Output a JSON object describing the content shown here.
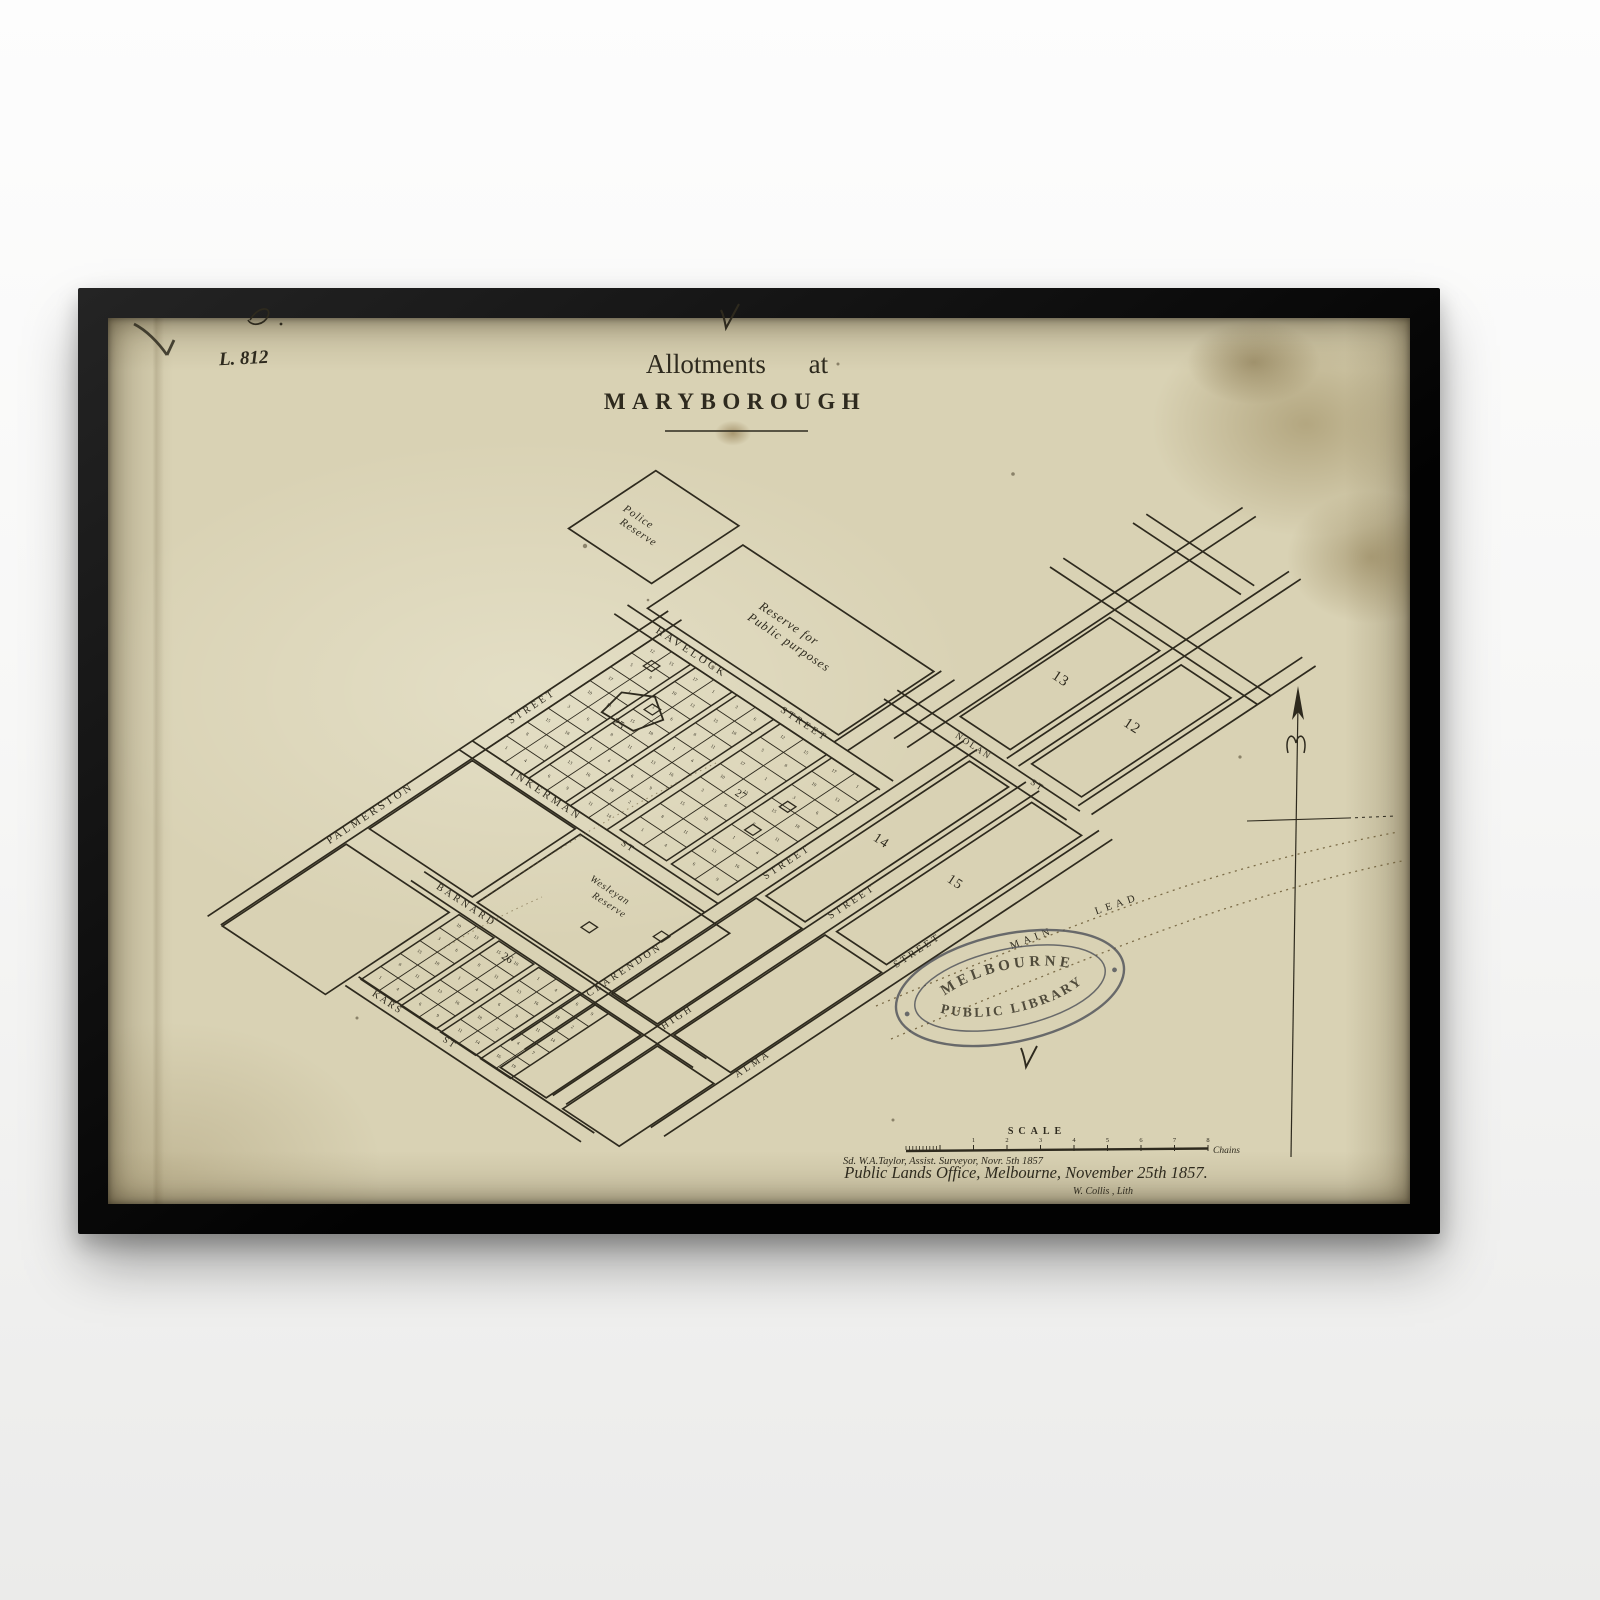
{
  "map": {
    "ink": "#2e2a1e",
    "stamp_ink": "#4d5058",
    "paper_color": "#d9d2b4",
    "catalog_number": "L. 812",
    "title": {
      "line1": "Allotments at",
      "line2": "MARYBOROUGH"
    },
    "reserves": {
      "police_l1": "Police",
      "police_l2": "Reserve",
      "public_l1": "Reserve for",
      "public_l2": "Public purposes",
      "wesleyan_l1": "Wesleyan",
      "wesleyan_l2": "Reserve"
    },
    "streets": {
      "palmerston": "PALMERSTON",
      "palmerston_st": "STREET",
      "inkerman": "INKERMAN",
      "inkerman_st": "ST",
      "havelock": "HAVELOCK",
      "havelock_st": "STREET",
      "barnard": "BARNARD",
      "kars": "KARS",
      "kars_st": "ST",
      "clarendon": "CLARENDON",
      "clarendon_st": "STREET",
      "high": "HIGH",
      "high_st": "STREET",
      "alma": "ALMA",
      "alma_st": "STREET",
      "nolan": "NOLAN",
      "nolan_st": "ST"
    },
    "blocks": {
      "b12": "12",
      "b13": "13",
      "b14": "14",
      "b15": "15",
      "b25": "25",
      "b26": "26",
      "b27": "27"
    },
    "lead": {
      "main": "MAIN",
      "lead": "LEAD"
    },
    "stamp": {
      "top": "MELBOURNE",
      "bottom": "PUBLIC LIBRARY"
    },
    "scale": {
      "title": "SCALE",
      "unit": "Chains",
      "ticks": [
        "1",
        "2",
        "3",
        "4",
        "5",
        "6",
        "7",
        "8"
      ]
    },
    "imprint": {
      "surveyor": "Sd. W.A.Taylor, Assist. Surveyor, Novr. 5th 1857",
      "office": "Public Lands Office, Melbourne, November 25th 1857.",
      "lith": "W. Collis , Lith"
    }
  }
}
